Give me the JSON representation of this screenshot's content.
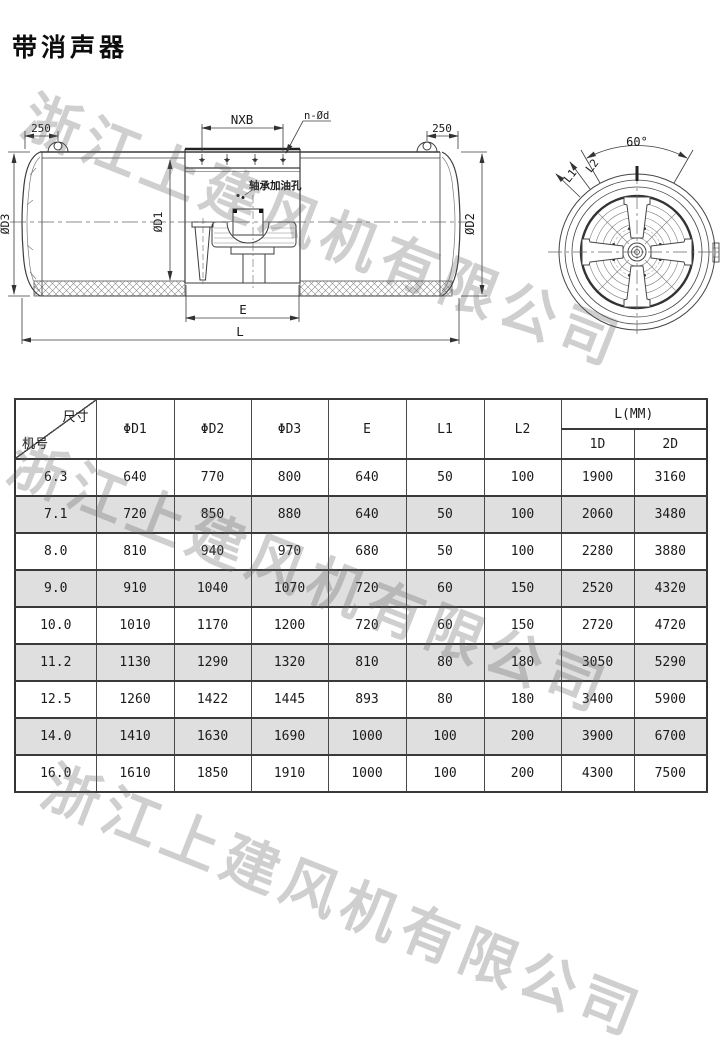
{
  "title": "带消声器",
  "watermark": {
    "text": "浙江上建风机有限公司"
  },
  "drawing": {
    "side_labels": {
      "dim_left_250": "250",
      "dim_right_250": "250",
      "nxb": "NXB",
      "n_holes": "n-Ød",
      "bearing_oil_hole": "轴承加油孔",
      "dia_d1": "ØD1",
      "dia_d2": "ØD2",
      "dia_d3": "ØD3",
      "dim_e": "E",
      "dim_l": "L"
    },
    "front_labels": {
      "angle_60": "60°",
      "dim_l1": "L1",
      "dim_l2": "L2"
    }
  },
  "table": {
    "corner_top_right": "尺寸",
    "corner_bottom_left": "机号",
    "headers": [
      "ΦD1",
      "ΦD2",
      "ΦD3",
      "E",
      "L1",
      "L2"
    ],
    "l_mm_header": "L(MM)",
    "l_mm_sub": [
      "1D",
      "2D"
    ],
    "rows": [
      {
        "model": "6.3",
        "values": [
          "640",
          "770",
          "800",
          "640",
          "50",
          "100",
          "1900",
          "3160"
        ]
      },
      {
        "model": "7.1",
        "values": [
          "720",
          "850",
          "880",
          "640",
          "50",
          "100",
          "2060",
          "3480"
        ]
      },
      {
        "model": "8.0",
        "values": [
          "810",
          "940",
          "970",
          "680",
          "50",
          "100",
          "2280",
          "3880"
        ]
      },
      {
        "model": "9.0",
        "values": [
          "910",
          "1040",
          "1070",
          "720",
          "60",
          "150",
          "2520",
          "4320"
        ]
      },
      {
        "model": "10.0",
        "values": [
          "1010",
          "1170",
          "1200",
          "720",
          "60",
          "150",
          "2720",
          "4720"
        ]
      },
      {
        "model": "11.2",
        "values": [
          "1130",
          "1290",
          "1320",
          "810",
          "80",
          "180",
          "3050",
          "5290"
        ]
      },
      {
        "model": "12.5",
        "values": [
          "1260",
          "1422",
          "1445",
          "893",
          "80",
          "180",
          "3400",
          "5900"
        ]
      },
      {
        "model": "14.0",
        "values": [
          "1410",
          "1630",
          "1690",
          "1000",
          "100",
          "200",
          "3900",
          "6700"
        ]
      },
      {
        "model": "16.0",
        "values": [
          "1610",
          "1850",
          "1910",
          "1000",
          "100",
          "200",
          "4300",
          "7500"
        ]
      }
    ]
  },
  "colors": {
    "row_alt": "#dfdfdf",
    "line": "#3c3c3c",
    "watermark": "#9a9a9a"
  }
}
